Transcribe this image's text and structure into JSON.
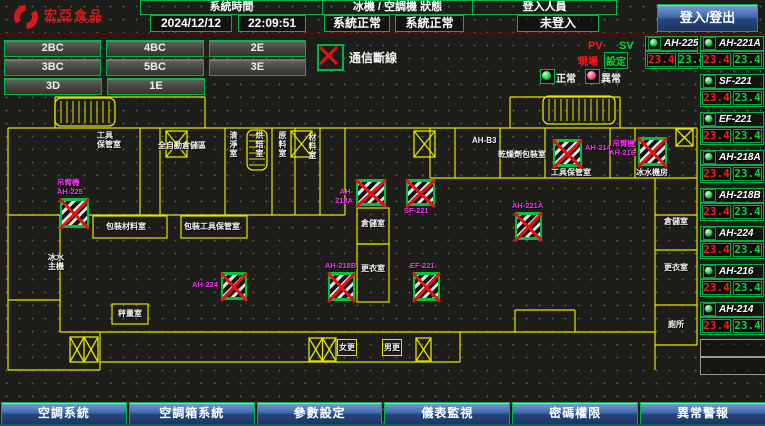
{
  "topbar": {
    "logo_text": "宏亞食品",
    "logo_subtext": "HUNYA FOODS",
    "system_time_label": "系統時間",
    "date": "2024/12/12",
    "time": "22:09:51",
    "status_label": "冰機 / 空調機 狀態",
    "chiller_status": "系統正常",
    "ahu_status": "系統正常",
    "login_label": "登入人員",
    "login_status": "未登入",
    "login_button": "登入/登出"
  },
  "floor_buttons": {
    "rows": [
      [
        "2BC",
        "4BC",
        "2E"
      ],
      [
        "3BC",
        "5BC",
        "3E"
      ],
      [
        "3D",
        "1E"
      ]
    ]
  },
  "comm_status": {
    "label": "通信斷線"
  },
  "legend": {
    "pv": "PV",
    "sv": "SV",
    "pv_sub": "現場",
    "sv_sub": "設定",
    "normal": "正常",
    "abnormal": "異常"
  },
  "equipment": {
    "items": [
      {
        "name": "AH-225",
        "pv": "23.4",
        "sv": "23.4",
        "x": 645,
        "y": 36,
        "w": 53
      },
      {
        "name": "AH-221A",
        "pv": "23.4",
        "sv": "23.4",
        "x": 700,
        "y": 36,
        "w": 64
      },
      {
        "name": "SF-221",
        "pv": "23.4",
        "sv": "23.4",
        "x": 700,
        "y": 74,
        "w": 64
      },
      {
        "name": "EF-221",
        "pv": "23.4",
        "sv": "23.4",
        "x": 700,
        "y": 112,
        "w": 64
      },
      {
        "name": "AH-218A",
        "pv": "23.4",
        "sv": "23.4",
        "x": 700,
        "y": 150,
        "w": 64
      },
      {
        "name": "AH-218B",
        "pv": "23.4",
        "sv": "23.4",
        "x": 700,
        "y": 188,
        "w": 64
      },
      {
        "name": "AH-224",
        "pv": "23.4",
        "sv": "23.4",
        "x": 700,
        "y": 226,
        "w": 64
      },
      {
        "name": "AH-216",
        "pv": "23.4",
        "sv": "23.4",
        "x": 700,
        "y": 264,
        "w": 64
      },
      {
        "name": "AH-214",
        "pv": "23.4",
        "sv": "23.4",
        "x": 700,
        "y": 302,
        "w": 64
      }
    ],
    "empty_slots": [
      {
        "x": 700,
        "y": 339,
        "w": 64,
        "h": 16
      },
      {
        "x": 700,
        "y": 357,
        "w": 64,
        "h": 16
      }
    ]
  },
  "floorplan": {
    "walls": [
      [
        55,
        97,
        205,
        97
      ],
      [
        510,
        97,
        620,
        97
      ],
      [
        8,
        128,
        697,
        128
      ],
      [
        8,
        215,
        345,
        215
      ],
      [
        430,
        178,
        697,
        178
      ],
      [
        8,
        300,
        60,
        300
      ],
      [
        60,
        332,
        655,
        332
      ],
      [
        100,
        362,
        460,
        362
      ],
      [
        8,
        370,
        100,
        370
      ],
      [
        655,
        215,
        697,
        215
      ],
      [
        655,
        250,
        697,
        250
      ],
      [
        655,
        305,
        697,
        305
      ],
      [
        655,
        345,
        697,
        345
      ],
      [
        515,
        310,
        575,
        310
      ],
      [
        55,
        97,
        55,
        128
      ],
      [
        205,
        97,
        205,
        128
      ],
      [
        510,
        97,
        510,
        128
      ],
      [
        620,
        97,
        620,
        128
      ],
      [
        8,
        128,
        8,
        370
      ],
      [
        697,
        128,
        697,
        345
      ],
      [
        655,
        178,
        655,
        370
      ],
      [
        140,
        128,
        140,
        215
      ],
      [
        160,
        128,
        160,
        215
      ],
      [
        225,
        128,
        225,
        215
      ],
      [
        272,
        128,
        272,
        215
      ],
      [
        295,
        128,
        295,
        215
      ],
      [
        320,
        128,
        320,
        215
      ],
      [
        345,
        128,
        345,
        215
      ],
      [
        430,
        128,
        430,
        178
      ],
      [
        455,
        128,
        455,
        178
      ],
      [
        500,
        128,
        500,
        178
      ],
      [
        545,
        128,
        545,
        178
      ],
      [
        610,
        128,
        610,
        178
      ],
      [
        635,
        128,
        635,
        178
      ],
      [
        60,
        215,
        60,
        332
      ],
      [
        100,
        332,
        100,
        370
      ],
      [
        460,
        332,
        460,
        362
      ],
      [
        515,
        310,
        515,
        332
      ],
      [
        575,
        310,
        575,
        332
      ]
    ],
    "room_rects": [
      [
        93,
        216,
        74,
        22
      ],
      [
        181,
        216,
        66,
        22
      ],
      [
        357,
        208,
        32,
        36
      ],
      [
        357,
        244,
        32,
        58
      ],
      [
        112,
        304,
        36,
        20
      ]
    ],
    "rooms": [
      {
        "text": "工具\n保管室",
        "x": 97,
        "y": 131
      },
      {
        "text": "全自動倉儲區",
        "x": 158,
        "y": 141
      },
      {
        "text": "清淨室",
        "x": 229,
        "y": 131,
        "vertical": true
      },
      {
        "text": "烘焙室",
        "x": 255,
        "y": 131,
        "vertical": true
      },
      {
        "text": "原料室",
        "x": 278,
        "y": 131,
        "vertical": true
      },
      {
        "text": "材料室",
        "x": 308,
        "y": 133,
        "vertical": true
      },
      {
        "text": "AH-B3",
        "x": 472,
        "y": 136
      },
      {
        "text": "乾燥劑包裝室",
        "x": 498,
        "y": 150
      },
      {
        "text": "工具保管室",
        "x": 551,
        "y": 168
      },
      {
        "text": "冰水機房",
        "x": 636,
        "y": 168
      },
      {
        "text": "倉儲室",
        "x": 361,
        "y": 219
      },
      {
        "text": "更衣室",
        "x": 361,
        "y": 264
      },
      {
        "text": "包裝材料室",
        "x": 106,
        "y": 222
      },
      {
        "text": "包裝工具保管室",
        "x": 184,
        "y": 222
      },
      {
        "text": "秤量室",
        "x": 118,
        "y": 309
      },
      {
        "text": "冰水\n主機",
        "x": 48,
        "y": 253
      },
      {
        "text": "倉儲室",
        "x": 664,
        "y": 217
      },
      {
        "text": "更衣室",
        "x": 664,
        "y": 263
      },
      {
        "text": "廁所",
        "x": 668,
        "y": 320
      },
      {
        "text": "女更",
        "x": 337,
        "y": 339,
        "boxed": true
      },
      {
        "text": "男更",
        "x": 382,
        "y": 339,
        "boxed": true
      }
    ],
    "ahus": [
      {
        "name": "AH-225",
        "prefix": "吊臂機",
        "x": 60,
        "y": 198,
        "w": 29,
        "h": 30,
        "lpos": "above"
      },
      {
        "name": "AH-224",
        "x": 221,
        "y": 272,
        "w": 26,
        "h": 28,
        "lpos": "left"
      },
      {
        "name": "AH-218A",
        "x": 356,
        "y": 179,
        "w": 30,
        "h": 27,
        "lpos": "left"
      },
      {
        "name": "SF-221",
        "x": 406,
        "y": 179,
        "w": 29,
        "h": 27,
        "lpos": "below"
      },
      {
        "name": "AH-218B",
        "x": 328,
        "y": 272,
        "w": 27,
        "h": 29,
        "lpos": "above"
      },
      {
        "name": "EF-221",
        "x": 413,
        "y": 272,
        "w": 27,
        "h": 29,
        "lpos": "above"
      },
      {
        "name": "AH-221A",
        "x": 515,
        "y": 212,
        "w": 27,
        "h": 28,
        "lpos": "above"
      },
      {
        "name": "AH-214",
        "x": 553,
        "y": 139,
        "w": 29,
        "h": 28,
        "lpos": "right"
      },
      {
        "name": "AH-216",
        "prefix": "吊臂機",
        "x": 638,
        "y": 137,
        "w": 29,
        "h": 29,
        "lpos": "left"
      }
    ],
    "doors": [
      {
        "x": 166,
        "y": 131,
        "w": 21,
        "h": 26,
        "type": "x"
      },
      {
        "x": 291,
        "y": 131,
        "w": 21,
        "h": 26,
        "type": "x"
      },
      {
        "x": 414,
        "y": 131,
        "w": 21,
        "h": 26,
        "type": "x"
      },
      {
        "x": 676,
        "y": 129,
        "w": 17,
        "h": 17,
        "type": "x"
      },
      {
        "x": 70,
        "y": 337,
        "w": 28,
        "h": 25,
        "type": "xx"
      },
      {
        "x": 309,
        "y": 338,
        "w": 27,
        "h": 23,
        "type": "xx"
      },
      {
        "x": 416,
        "y": 338,
        "w": 15,
        "h": 23,
        "type": "x"
      }
    ],
    "stairs": [
      {
        "x": 55,
        "y": 98,
        "w": 60,
        "h": 28,
        "dir": "h"
      },
      {
        "x": 543,
        "y": 96,
        "w": 72,
        "h": 28,
        "dir": "h"
      },
      {
        "x": 247,
        "y": 130,
        "w": 20,
        "h": 40,
        "dir": "v"
      }
    ]
  },
  "bottom_buttons": [
    "空調系統",
    "空調箱系統",
    "參數設定",
    "儀表監視",
    "密碼權限",
    "異常警報"
  ],
  "colors": {
    "background": "#1d1d19",
    "grid_dot": "#56564a",
    "border_green": "#00b44a",
    "wall_yellow": "#e4e400",
    "label_magenta": "#ff2cff",
    "pv_red": "#ff1a1a",
    "sv_green": "#00dd30",
    "alarm_red": "#e81010",
    "button_blue": "#3f6bae",
    "logo_red": "#d51820"
  }
}
